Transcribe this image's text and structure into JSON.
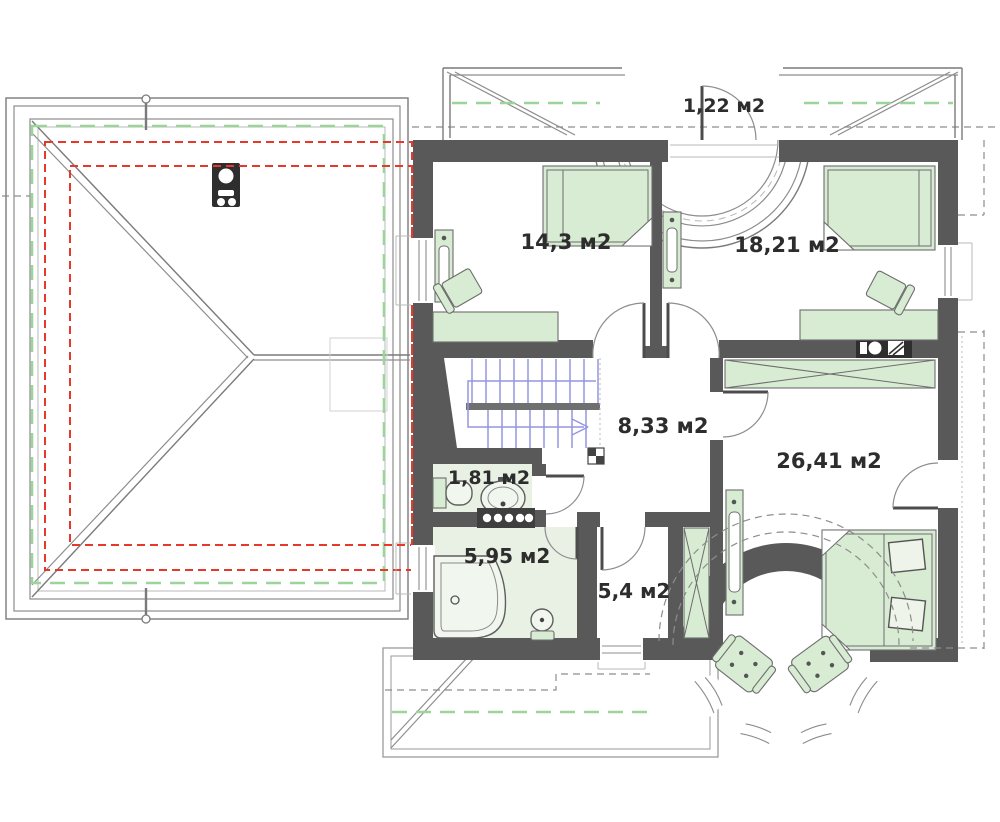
{
  "plan": {
    "type": "floor-plan",
    "units_label": "м2",
    "rooms": [
      {
        "id": "balcony",
        "area_label": "1,22 м2"
      },
      {
        "id": "bedroom-left",
        "area_label": "14,3 м2"
      },
      {
        "id": "bedroom-right",
        "area_label": "18,21 м2"
      },
      {
        "id": "hall",
        "area_label": "8,33 м2"
      },
      {
        "id": "master-bedroom",
        "area_label": "26,41 м2"
      },
      {
        "id": "wc",
        "area_label": "1,81 м2"
      },
      {
        "id": "bathroom",
        "area_label": "5,95 м2"
      },
      {
        "id": "closet",
        "area_label": "5,4 м2"
      }
    ],
    "colors": {
      "wall": "#595959",
      "furniture_fill": "#d8ebd3",
      "wet_floor": "#e9f1e4",
      "stairs": "#9595e0",
      "red_dashed": "#e6392b",
      "green_dashed": "#9cd49c",
      "line_gray": "#8d8d8d",
      "background": "#ffffff"
    }
  }
}
